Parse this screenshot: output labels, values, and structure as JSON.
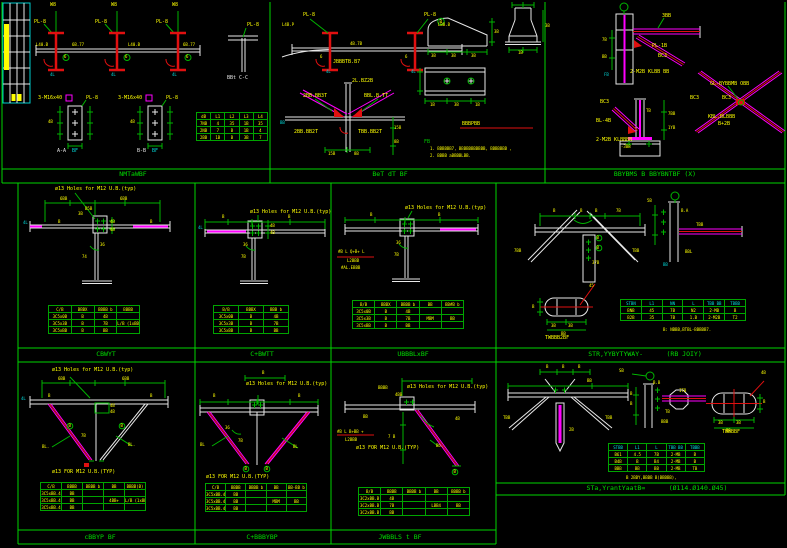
{
  "colors": {
    "bg": "#000000",
    "frame": "#00d400",
    "dims": "#00b400",
    "geometry": "#e8e8e8",
    "steel_member": "#ff00ff",
    "highlight": "#e01010",
    "text": "#ffff00",
    "aux": "#00cccc",
    "title": "#00dd00"
  },
  "common": {
    "pl8": "PL-8",
    "holes": "ø13 Holes for M12 U.B.(typ)",
    "holes_cap": "ø13 FOR M12 U.B.(TYP)",
    "bolt3": "3-M16x40",
    "weld": "6",
    "mark": "4L"
  },
  "panels": {
    "t1": {
      "title": "NMTaWBF",
      "grid": [
        "W8",
        "W8",
        "W8"
      ],
      "seg_a": "L40.B",
      "seg_b": "6B.77",
      "tsec": "BBt C-C",
      "det_a": "A-A",
      "det_b": "B-B",
      "det_sfx": "BF",
      "dim40": "4B",
      "table": {
        "headers": [
          "dB",
          "L1",
          "L2",
          "L3",
          "L4"
        ],
        "rows": [
          [
            "7NB",
            "4",
            "35",
            "1B",
            "35"
          ],
          [
            "2NB",
            "7",
            "B",
            "1B",
            "4"
          ],
          [
            "2BB",
            "1B",
            "B",
            "3B",
            "7"
          ]
        ]
      }
    },
    "t2": {
      "title": "BeT dT BF",
      "lbl_left": "L4B.P",
      "lbl_right": "LBB.B",
      "lbl_mid": "4B.7B",
      "sub": "JBBBTB.B7",
      "brace_top": "2L.BZ2B",
      "brace_l": "2BB.BB3T",
      "brace_r": "BBL.B.TT",
      "brace_bl": "2BB.BB2T",
      "brace_br": "TBB.BB2T",
      "mark_bb": "BB",
      "dim150": "15B",
      "dim80": "8B",
      "dim35": "3B",
      "dim30": "3B",
      "dim14": "1B",
      "circ8": "B",
      "plate_dim1": "1B",
      "plate_dim2": "3B",
      "struck": "BBBPBB",
      "note_hdr": "FB",
      "note1": "1. BBBBBB7, BBBBBBBBBBB, BBBBBBB ,",
      "note2": "2. BBBB aBBBBLBB."
    },
    "t3": {
      "title": "BBYBMS B BBYBNTBF (X)",
      "dim300": "3BB",
      "pl10": "PL-1B",
      "bc3": "BC3",
      "bolt": "2-M2B KLBB BB",
      "fb": "FB",
      "dim78": "7B",
      "dim88": "BB",
      "base_bc3": "BC3",
      "pl48": "BL-4B",
      "base_bolt": "2-M2B KLBBBB",
      "tb": "TB",
      "dim7b": "7BB",
      "dim1y": "1YB",
      "lvl": "-3BB",
      "x_lbl": "GL-BYBBMB OBB",
      "x_bc3a": "BC3",
      "x_bc3b": "BC3",
      "x_l1": "KBL.BLBBB",
      "x_l2": "B+2B"
    },
    "m1": {
      "title": "CBWYT",
      "d600a": "6BB",
      "d600b": "6BB",
      "d150": "B5B",
      "d30": "3B",
      "d40": "4B",
      "d36": "36",
      "d74": "74",
      "b": "B",
      "table": {
        "headers": [
          "C/B",
          "BBBX",
          "BBBB b",
          "BBBB"
        ],
        "rows": [
          [
            "3C5x0B",
            "B",
            "4B",
            ""
          ],
          [
            "3C5x3B",
            "B",
            "7B",
            "L/B (1xBB)"
          ],
          [
            "3C5xBB",
            "B",
            "BB",
            ""
          ]
        ]
      }
    },
    "m2": {
      "title": "C+BWTT",
      "d36": "36",
      "d7b": "7B",
      "d40": "4B",
      "b": "B",
      "table": {
        "headers": [
          "B/B",
          "BBBX",
          "BBB b"
        ],
        "rows": [
          [
            "3C5x0B",
            "B",
            "4B"
          ],
          [
            "3C5x3B",
            "B",
            "7B"
          ],
          [
            "3C5xBB",
            "B",
            "BB"
          ]
        ]
      }
    },
    "m3": {
      "title": "UBBBLxBF",
      "d36": "36",
      "d7b": "7B",
      "b": "B",
      "lbl1": "#B L Q+B+ L",
      "lbl2": "L2BBB",
      "lbl3": "#AL.EBBB",
      "table": {
        "headers": [
          "B/B",
          "BBBX",
          "BBBB b",
          "BB",
          "BB#B b"
        ],
        "rows": [
          [
            "3C5x0B",
            "B",
            "4B",
            "",
            ""
          ],
          [
            "3C5x3B",
            "B",
            "7B",
            "MBM",
            "BB"
          ],
          [
            "3C5xBB",
            "B",
            "BB",
            "",
            ""
          ]
        ]
      }
    },
    "m4": {
      "title": "STR,YYBYTYWAY-      (RB JOIY)",
      "d7b": "7B",
      "b": "B",
      "l7bb": "7BB",
      "ltbb": "TBB",
      "slope": "37B",
      "ang45": "45",
      "od35a": "3B",
      "od35b": "3B",
      "od": "BB",
      "odb": "B",
      "oval_lbl": "TWBBB2BF",
      "sv_sb": "5B",
      "sv_ba": "B.A",
      "sv_tbb": "TBB",
      "sv_bbl": "BBL",
      "sv_bb": "BB",
      "note": "B: NBBB,BTBL-BBBBB7.",
      "table": {
        "headers": [
          "STBN",
          "L1",
          "NN",
          "L",
          "TBB BB",
          "TBBB"
        ],
        "rows": [
          [
            "BNB",
            "45",
            "7B",
            "N2",
            "2-MB",
            "B"
          ],
          [
            "B2B",
            "35",
            "7B",
            "1.B",
            "2-M2B",
            "T2"
          ]
        ]
      }
    },
    "b1": {
      "title": "cBBYP BF",
      "d600a": "6BB",
      "d600b": "6BB",
      "d40": "4B",
      "d7b": "7B",
      "bl_l": "BL.",
      "bl_r": "BL.",
      "b": "B",
      "table": {
        "headers": [
          "C/B",
          "BBBB",
          "BBBB b",
          "BB",
          "BBBB(B)"
        ],
        "rows": [
          [
            "3C5xBB.4",
            "BB",
            "",
            "",
            ""
          ],
          [
            "3C5xBB.4",
            "BB",
            "",
            "4BB+",
            "L/B (1xBB)"
          ],
          [
            "3C5xBB.4",
            "BB",
            "",
            "",
            ""
          ]
        ]
      }
    },
    "b2": {
      "title": "C+BBBYBP",
      "dtop": "B",
      "d36": "36",
      "d7b": "7B",
      "bl_l": "BL",
      "bl_r": "BL",
      "b": "B",
      "table": {
        "headers": [
          "C/B",
          "BBBB",
          "BBBB b",
          "BB",
          "BB-BB b"
        ],
        "rows": [
          [
            "3C5xBB.4",
            "BB",
            "",
            "",
            ""
          ],
          [
            "3C5xBB.4",
            "BB",
            "",
            "MBM",
            "BB"
          ],
          [
            "3C5xBB.4",
            "BB",
            "",
            "",
            ""
          ]
        ]
      }
    },
    "b3": {
      "title": "JWBBLS t BF",
      "dtop": "BBBB",
      "d4bb": "4BB",
      "dbb": "BB",
      "lbl1": "#B L B+BB +",
      "lbl2": "L2BBB",
      "d7b": "7 B",
      "bb_lbl": "Bb.",
      "d45": "4B",
      "b": "B",
      "table": {
        "headers": [
          "B/B",
          "BBBB",
          "BBBB b",
          "BB",
          "BBBB b"
        ],
        "rows": [
          [
            "3C2xBB.B",
            "4B",
            "",
            "",
            ""
          ],
          [
            "3C2xBB.B",
            "7B",
            "",
            "LBB4",
            "BB"
          ],
          [
            "3C2xBB.B",
            "BB",
            "",
            "",
            ""
          ]
        ]
      }
    },
    "b4": {
      "title": "STa,YrantYaatB=      (Ø114.Ø140.Ø45)",
      "da": "B",
      "db": "B",
      "dc": "B",
      "dbb": "BB",
      "tbb_l": "TBB",
      "tbb_r": "TBB",
      "d2b": "2B",
      "sb": "SB",
      "sv_bb": "B.B",
      "sv_itb": "ITB",
      "sv_tb": "TB",
      "sv_bbb": "BBB",
      "st35a": "3B",
      "st35b": "3B",
      "st_bb": "BB",
      "st_b": "B",
      "st45": "4B",
      "st_lbl": "TBBBBF",
      "note": "B 2BBY,BBBB B(BBBBB),",
      "table": {
        "headers": [
          "STBB",
          "L1",
          "L",
          "TBB BB",
          "TBBB"
        ],
        "rows": [
          [
            "B61",
            "4.5",
            "7B",
            "2-MB",
            "B"
          ],
          [
            "B4B",
            "B",
            "B4",
            "2-MB",
            "B"
          ],
          [
            "BBB",
            "BB",
            "BB",
            "2-MB",
            "TB"
          ]
        ]
      }
    }
  }
}
